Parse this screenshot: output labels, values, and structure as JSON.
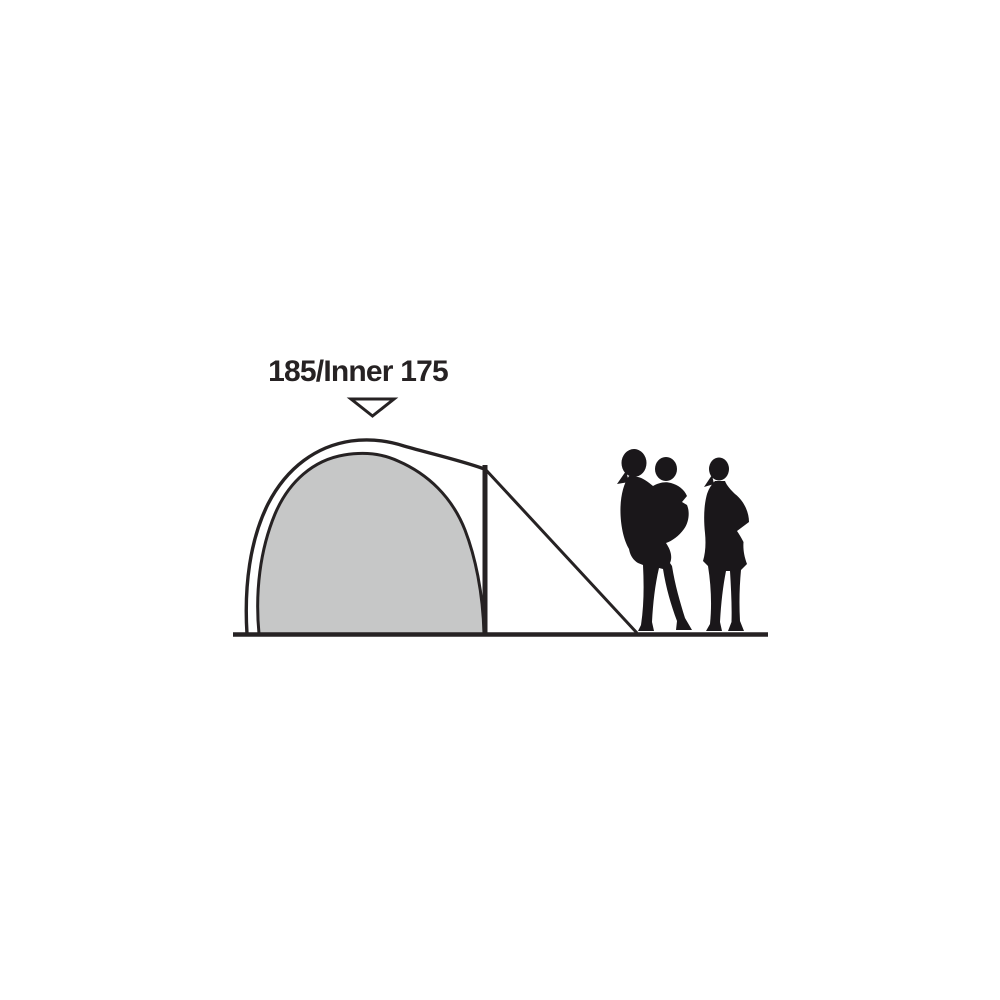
{
  "diagram": {
    "height_label": "185/Inner 175",
    "marker": "triangle-down",
    "figures": [
      "tent-side-profile",
      "adult-holding-child-silhouette",
      "adult-silhouette"
    ]
  },
  "colors": {
    "ink": "#262223",
    "inner_tent_fill": "#c6c7c7",
    "silhouette": "#1a171a",
    "background": "#ffffff"
  }
}
